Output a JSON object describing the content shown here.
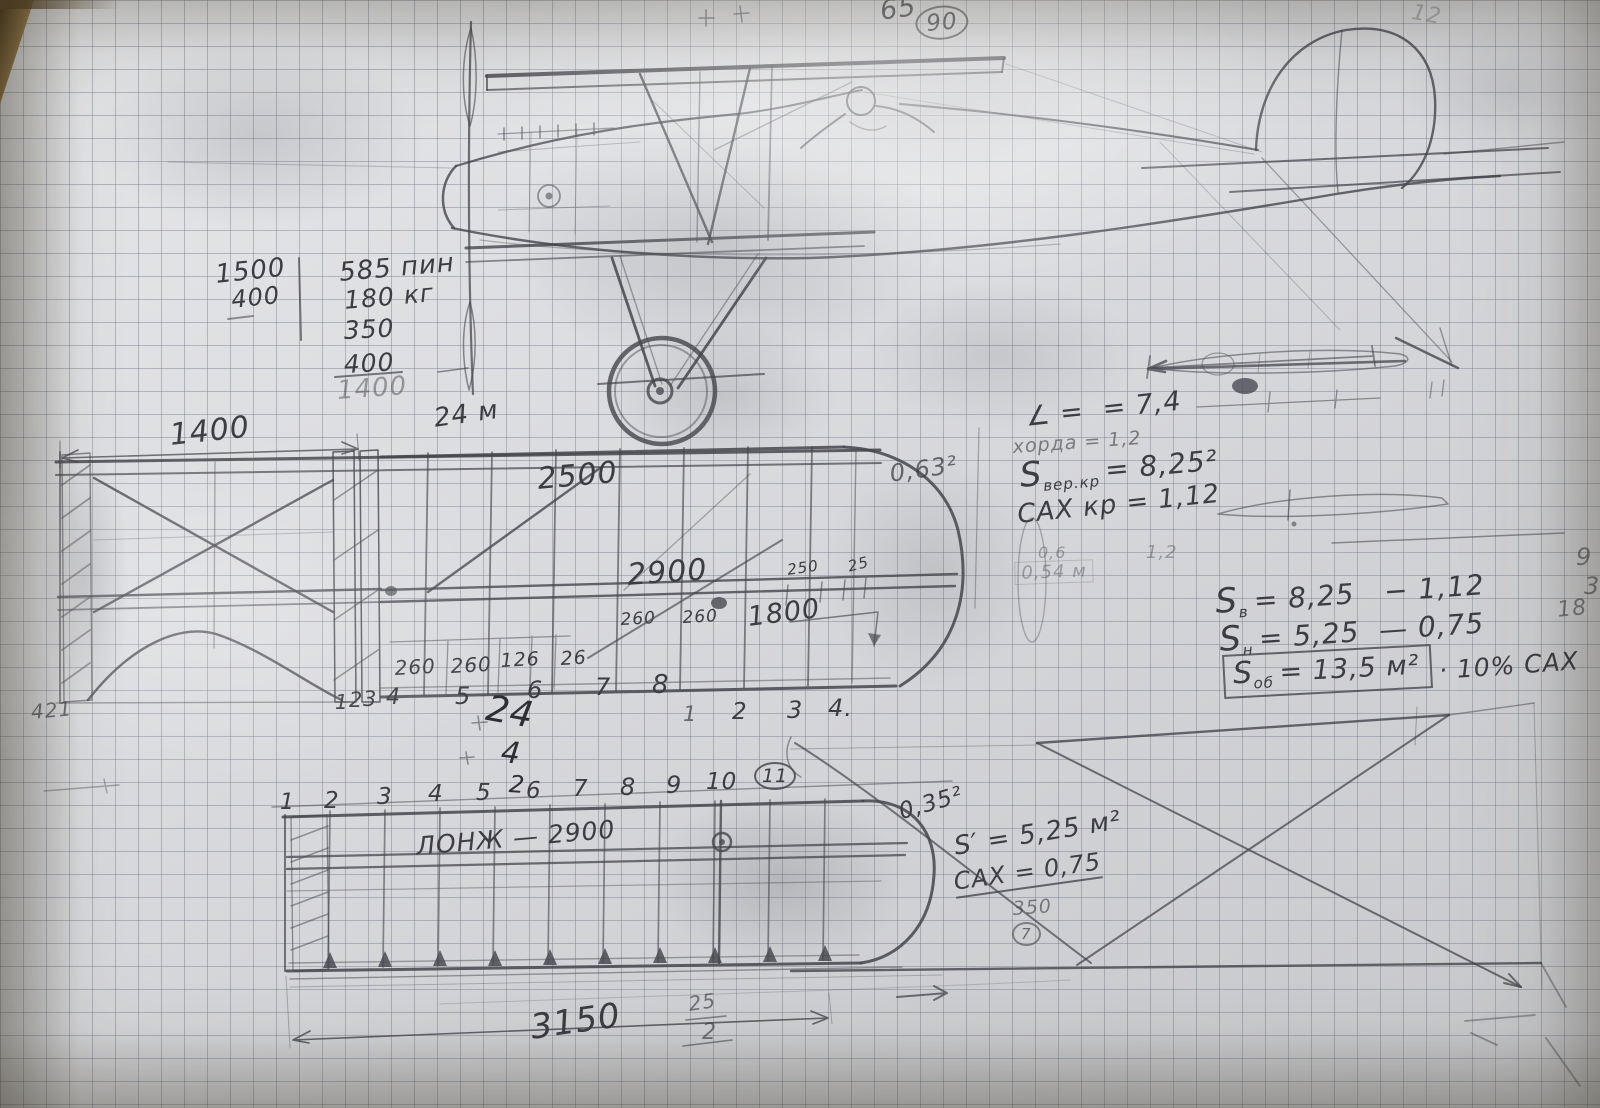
{
  "header": {
    "num65": "65",
    "num90": "90",
    "num12": "12"
  },
  "weight_calc": {
    "r1": "1500",
    "r2": "400",
    "c1": "585 пин",
    "c2": "180 кг",
    "c3": "350",
    "c4": "400",
    "sum": "1400"
  },
  "dims": {
    "prop": "24 м",
    "front_span": "1400",
    "upper": "2500",
    "spar": "2900",
    "d250": "250",
    "d25": "25",
    "d260a": "260",
    "d260b": "260",
    "d1800": "1800",
    "cell1": "260",
    "cell2": "260",
    "cell3": "126",
    "cell4": "26",
    "note421": "421",
    "span3150": "3150",
    "frac_top": "25",
    "frac_bot": "2"
  },
  "upper_ribs": [
    "1",
    "2",
    "3",
    "4",
    "5",
    "6",
    "7",
    "8"
  ],
  "upper_ribs_b": [
    "1",
    "2",
    "3",
    "4."
  ],
  "scribbles": {
    "a": "24",
    "b": "4",
    "c": "2"
  },
  "aero": {
    "c063": "0,63²",
    "angle": "∠ =  = 7,4",
    "chord": "хорда = 1,2",
    "s": "S",
    "sub_top": "вер.кр",
    "val_top": "= 8,25²",
    "sah_top": "САХ кр = 1,12",
    "f06": "0,6",
    "f054": "0,54 м",
    "f12": "1,2",
    "sub_v": "в",
    "val_v": "= 8,25   − 1,12",
    "sub_n": "н",
    "val_n": "= 5,25  — 0,75",
    "sub_ob": "об",
    "val_ob": "= 13,5 м²",
    "ob_note": "· 10% САХ",
    "e9": "9",
    "e3": "3",
    "e18": "18"
  },
  "lower": {
    "ribs": [
      "1",
      "2",
      "3",
      "4",
      "5",
      "6",
      "7",
      "8",
      "9",
      "10",
      "11"
    ],
    "spar_label": "ЛОНЖ — 2900",
    "tip": "0,35²",
    "s_prime": "S′ = 5,25 м²",
    "sah": "САХ = 0,75",
    "v350": "350",
    "circ7": "7"
  }
}
